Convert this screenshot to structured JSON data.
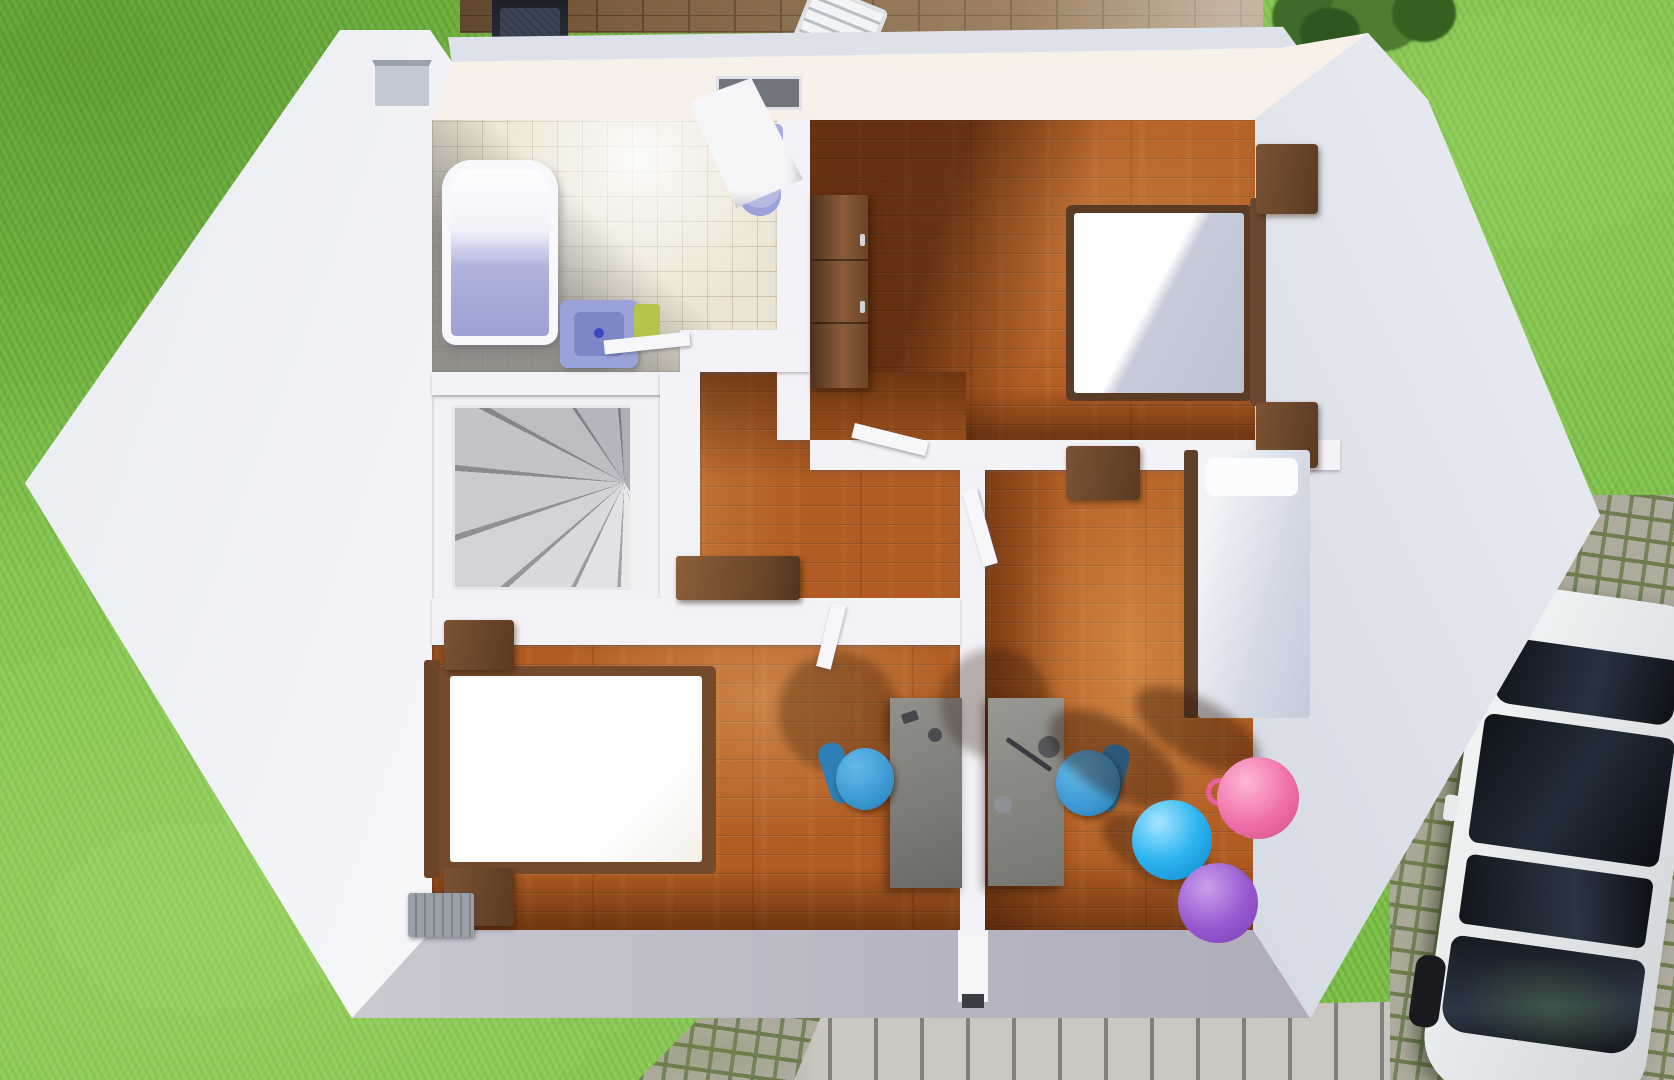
{
  "scene": {
    "title": "Top-down 3D render of an upper-storey floor plan with garden, deck and parked car",
    "type": "architectural-3d-render",
    "view": "top-down dollhouse"
  },
  "palette": {
    "grass": "#7cbf49",
    "wall_white": "#fafafc",
    "wall_top_warm": "#f5efe7",
    "wall_inner_gray": "#c2c6d2",
    "wood_floor": "#b05c22",
    "tile_floor": "#ece4d2",
    "deck_wood": "#7d6142",
    "fixture_lavender": "#9aa2da",
    "towel_green": "#b7c44b",
    "chair_blue": "#3f9bd4",
    "ball_blue": "#2cb4f0",
    "ball_pink": "#ef6fa9",
    "ball_purple": "#9757cf",
    "car_body": "#eef1f2",
    "car_glass": "#141a21",
    "tail_light_red": "#c2302a"
  },
  "exterior": {
    "lawn": "garden lawn",
    "deck": "wooden terrace deck",
    "grill": "barbecue grill",
    "lounge_chair": "slatted deck chair",
    "bush": "shrub",
    "patio": "grey plank patio",
    "path": "cobblestone path corner",
    "driveway": "cobblestone driveway",
    "car": "white car seen from above"
  },
  "rooms": [
    {
      "name": "bathroom",
      "floor": "beige tiles",
      "items": [
        "bathtub",
        "washbasin",
        "green towel",
        "toilet",
        "vent shaft"
      ]
    },
    {
      "name": "stairwell",
      "floor": "white",
      "items": [
        "winder spiral staircase"
      ]
    },
    {
      "name": "hallway",
      "floor": "wood planks",
      "items": [
        "console table",
        "open doors"
      ]
    },
    {
      "name": "bedroom-top-right",
      "floor": "wood planks",
      "items": [
        "double bed",
        "nightstand",
        "nightstand",
        "wardrobe"
      ]
    },
    {
      "name": "bedroom-bottom-left",
      "floor": "wood planks",
      "items": [
        "double bed with white duvet",
        "nightstand",
        "nightstand",
        "desk",
        "blue desk chair",
        "radiator"
      ]
    },
    {
      "name": "bedroom-right",
      "floor": "wood planks",
      "items": [
        "single bed",
        "wall cabinet",
        "desk",
        "desk lamp",
        "blue desk chair",
        "blue gym ball",
        "pink gym ball",
        "purple gym ball"
      ]
    }
  ]
}
